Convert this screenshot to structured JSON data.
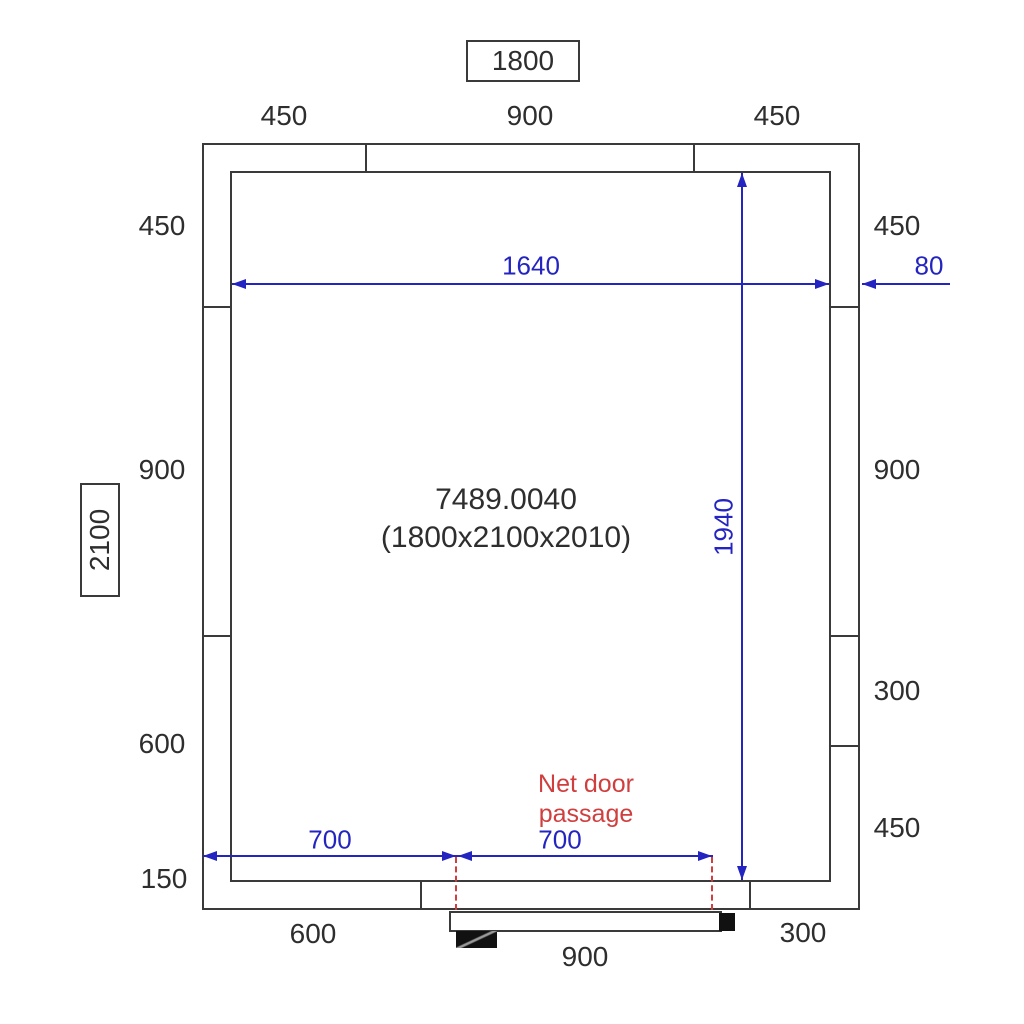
{
  "drawing": {
    "overall_width_box": "1800",
    "overall_height_box": "2100",
    "product_code": "7489.0040",
    "product_dimensions": "(1800x2100x2010)"
  },
  "panels": {
    "top": [
      "450",
      "900",
      "450"
    ],
    "left": [
      "450",
      "900",
      "600",
      "150"
    ],
    "right": [
      "450",
      "900",
      "300",
      "450"
    ],
    "bottom": [
      "600",
      "900",
      "300"
    ]
  },
  "inner_dimensions": {
    "clear_width": "1640",
    "clear_height": "1940",
    "wall_thickness": "80",
    "door_offset_left": "700",
    "door_passage": "700"
  },
  "door_note": {
    "line1": "Net door",
    "line2": "passage"
  },
  "colors": {
    "wall_line": "#3a3a3a",
    "dimension_blue": "#2424c0",
    "warning_red": "#d03e3e",
    "door_black": "#111111"
  }
}
